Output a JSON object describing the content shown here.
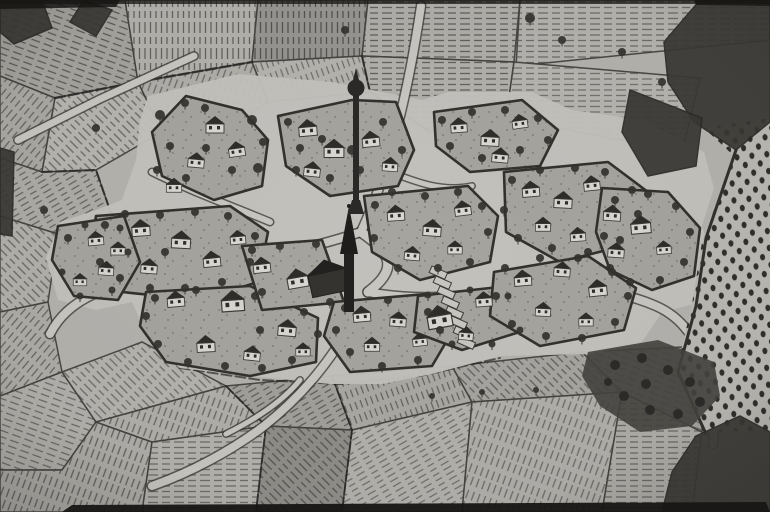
{
  "map": {
    "kind": "scanned-woodcut-village-map",
    "width": 770,
    "height": 512
  },
  "palette": {
    "paper": "#b4b2ad",
    "ground": "#c3c1bc",
    "island": "#a6a49e",
    "ink": "#3b3936",
    "inkDark": "#22211f",
    "hatch": "#504e4a",
    "wall": "#d9d7d1",
    "roof": "#2e2d2a",
    "tree": "#33322e",
    "forest": "#3a3834",
    "grove": "#45433e",
    "orchardBase": "#bab8b3",
    "orchardDot": "#2f2e2b",
    "road": "#c8c6c1",
    "black": "#161513"
  },
  "patterns": [
    {
      "id": "h0",
      "angle": 0,
      "sp": 5.5,
      "w": 1.3,
      "dash": "7 4"
    },
    {
      "id": "h20",
      "angle": 20,
      "sp": 6,
      "w": 1.3,
      "dash": "9 5"
    },
    {
      "id": "h40",
      "angle": 40,
      "sp": 6,
      "w": 1.2,
      "dash": "8 4"
    },
    {
      "id": "h60",
      "angle": 60,
      "sp": 5.5,
      "w": 1.2,
      "dash": "7 5"
    },
    {
      "id": "h90",
      "angle": 90,
      "sp": 5.5,
      "w": 1.3,
      "dash": "8 4"
    },
    {
      "id": "h110",
      "angle": 110,
      "sp": 6,
      "w": 1.2,
      "dash": "9 4"
    },
    {
      "id": "h135",
      "angle": 135,
      "sp": 6,
      "w": 1.3,
      "dash": "7 4"
    },
    {
      "id": "h160",
      "angle": 160,
      "sp": 5.5,
      "w": 1.2,
      "dash": "8 5"
    }
  ],
  "fields": [
    {
      "pts": "0,0 125,0 138,82 55,98 0,76",
      "tint": "#a5a39e",
      "pat": "h110",
      "o": 0.9
    },
    {
      "pts": "125,0 258,0 252,62 138,82",
      "tint": "#b3b1ac",
      "pat": "h0",
      "o": 0.8
    },
    {
      "pts": "258,0 368,0 362,56 252,62",
      "tint": "#969490",
      "pat": "h0",
      "o": 0.95
    },
    {
      "pts": "368,0 520,0 514,62 362,56",
      "tint": "#b0aea9",
      "pat": "h90",
      "o": 0.8
    },
    {
      "pts": "520,0 770,0 770,40 516,66",
      "tint": "#b5b3ae",
      "pat": "h90",
      "o": 0.7
    },
    {
      "pts": "0,76 55,98 42,172 0,158",
      "tint": "#aaa8a3",
      "pat": "h40",
      "o": 0.8
    },
    {
      "pts": "55,98 138,82 162,132 96,170 42,172",
      "tint": "#b8b6b1",
      "pat": "h135",
      "o": 0.75
    },
    {
      "pts": "138,82 252,62 268,102 206,142 162,132",
      "tint": "#b0aea9",
      "pat": "h20",
      "o": 0.7
    },
    {
      "pts": "252,62 362,56 370,92 268,102",
      "tint": "#b6b4af",
      "pat": "h160",
      "o": 0.7
    },
    {
      "pts": "362,56 514,62 506,118 430,132 370,92",
      "tint": "#b2b0ab",
      "pat": "h90",
      "o": 0.8
    },
    {
      "pts": "514,62 700,78 682,152 506,118",
      "tint": "#b7b5b0",
      "pat": "h90",
      "o": 0.65
    },
    {
      "pts": "0,158 42,172 96,170 112,216 58,234 0,216",
      "tint": "#adaba6",
      "pat": "h60",
      "o": 0.8
    },
    {
      "pts": "0,216 58,234 48,302 0,312",
      "tint": "#b2b0ab",
      "pat": "h135",
      "o": 0.75
    },
    {
      "pts": "0,312 48,302 62,372 0,396",
      "tint": "#aeaca7",
      "pat": "h40",
      "o": 0.8
    },
    {
      "pts": "0,396 62,372 96,422 62,470 0,470",
      "tint": "#b3b1ac",
      "pat": "h110",
      "o": 0.75
    },
    {
      "pts": "0,470 62,470 96,422 152,442 142,512 0,512",
      "tint": "#afada8",
      "pat": "h20",
      "o": 0.8
    },
    {
      "pts": "62,372 142,342 226,386 96,422",
      "tint": "#b6b4af",
      "pat": "h135",
      "o": 0.7
    },
    {
      "pts": "96,422 226,386 266,426 152,442",
      "tint": "#b1afaa",
      "pat": "h20",
      "o": 0.75
    },
    {
      "pts": "152,442 266,426 256,512 142,512",
      "tint": "#b4b2ad",
      "pat": "h90",
      "o": 0.7
    },
    {
      "pts": "226,386 332,376 352,430 266,426",
      "tint": "#a2a09b",
      "pat": "h60",
      "o": 0.85
    },
    {
      "pts": "266,426 352,430 342,512 256,512",
      "tint": "#8f8d88",
      "pat": "h135",
      "o": 0.9
    },
    {
      "pts": "332,376 452,366 472,402 352,430",
      "tint": "#aaa8a3",
      "pat": "h160",
      "o": 0.8
    },
    {
      "pts": "352,430 472,402 462,512 342,512",
      "tint": "#b3b1ac",
      "pat": "h60",
      "o": 0.7
    },
    {
      "pts": "452,366 582,352 622,392 472,402",
      "tint": "#a7a5a0",
      "pat": "h135",
      "o": 0.8
    },
    {
      "pts": "472,402 622,392 602,512 462,512",
      "tint": "#b1afaa",
      "pat": "h20",
      "o": 0.7
    },
    {
      "pts": "602,512 622,392 702,432 692,512",
      "tint": "#aeaca7",
      "pat": "h90",
      "o": 0.7
    },
    {
      "pts": "582,352 702,346 702,432 622,392",
      "tint": "#a5a39e",
      "pat": "h110",
      "o": 0.7
    }
  ],
  "seams": [
    {
      "pts": "42,172 96,170 112,216",
      "w": 2.2
    },
    {
      "pts": "362,56 370,92 430,132",
      "w": 2.2
    },
    {
      "pts": "226,386 266,426 256,512",
      "w": 2
    },
    {
      "pts": "332,376 352,430 342,512",
      "w": 2
    },
    {
      "pts": "55,98 138,82 252,62",
      "w": 2.5
    },
    {
      "pts": "180,368 260,380 340,384 420,376 500,358",
      "w": 2
    }
  ],
  "villageGround": {
    "pts": "148,96 238,74 332,82 422,100 448,92 532,92 572,110 642,120 704,152 714,188 702,226 714,264 702,302 662,312 642,342 592,354 500,356 432,374 382,384 330,384 230,374 180,368 150,342 132,302 96,310 58,300 46,258 60,222 96,210 122,200 136,160 140,120"
  },
  "islands": [
    {
      "pts": "186,96 242,110 268,140 262,186 214,200 162,176 152,132"
    },
    {
      "pts": "278,116 352,100 396,102 414,150 398,186 330,196 286,166"
    },
    {
      "pts": "434,112 522,100 558,130 540,166 470,172 436,146"
    },
    {
      "pts": "96,216 230,206 268,232 258,282 200,300 122,292 90,256"
    },
    {
      "pts": "58,226 124,216 140,262 118,300 74,296 52,260"
    },
    {
      "pts": "146,292 250,286 318,318 316,362 250,376 166,362 140,326"
    },
    {
      "pts": "242,246 322,240 344,302 262,310"
    },
    {
      "pts": "334,302 426,294 452,332 432,366 350,372 324,336"
    },
    {
      "pts": "418,296 508,286 526,330 462,350 414,332"
    },
    {
      "pts": "364,196 468,186 498,216 490,262 420,280 372,252"
    },
    {
      "pts": "504,172 608,162 648,192 638,242 560,262 506,232"
    },
    {
      "pts": "494,272 588,256 636,288 624,330 540,346 490,316"
    },
    {
      "pts": "602,188 668,192 700,228 694,276 652,290 610,270 596,232"
    }
  ],
  "roads": [
    {
      "d": "M18,140 L100,99 L194,56",
      "w": 7
    },
    {
      "d": "M421,6 C413,60 401,120 385,170 C377,196 369,214 361,232",
      "w": 8
    },
    {
      "d": "M361,232 C300,252 258,258 200,262 C160,266 122,277 94,294 C72,304 58,318 50,334",
      "w": 8
    },
    {
      "d": "M368,292 C420,302 468,296 520,289 C570,283 622,291 656,306 C686,319 700,346 707,374 C713,399 715,420 713,444",
      "w": 8
    },
    {
      "d": "M354,318 C332,360 302,396 264,426 C232,450 192,472 152,486",
      "w": 8
    },
    {
      "d": "M300,380 C282,402 254,420 226,434",
      "w": 5
    },
    {
      "d": "M152,172 C192,192 232,206 270,222",
      "w": 6
    },
    {
      "d": "M385,170 C420,184 444,192 472,186",
      "w": 5
    },
    {
      "d": "M361,232 C390,252 400,268 368,292",
      "w": 9
    }
  ],
  "gardenPlots": {
    "x0": 432,
    "y0": 266,
    "dx": 4,
    "dy": 10,
    "n": 8,
    "w": 17,
    "h": 7,
    "rot": 24
  },
  "houses": [
    [
      215,
      128,
      1,
      0
    ],
    [
      237,
      152,
      0.9,
      -8
    ],
    [
      196,
      163,
      0.9,
      5
    ],
    [
      174,
      188,
      0.85,
      0
    ],
    [
      308,
      131,
      1,
      -5
    ],
    [
      334,
      152,
      1.1,
      0
    ],
    [
      312,
      172,
      0.9,
      6
    ],
    [
      371,
      142,
      0.95,
      -6
    ],
    [
      390,
      167,
      0.85,
      4
    ],
    [
      459,
      128,
      0.9,
      -4
    ],
    [
      490,
      141,
      1,
      3
    ],
    [
      520,
      124,
      0.85,
      -8
    ],
    [
      500,
      158,
      0.9,
      5
    ],
    [
      141,
      231,
      1,
      -4
    ],
    [
      181,
      243,
      1.05,
      3
    ],
    [
      212,
      262,
      0.95,
      -6
    ],
    [
      149,
      269,
      0.9,
      4
    ],
    [
      118,
      251,
      0.8,
      0
    ],
    [
      238,
      240,
      0.85,
      -5
    ],
    [
      96,
      241,
      0.85,
      -5
    ],
    [
      106,
      271,
      0.85,
      4
    ],
    [
      80,
      282,
      0.75,
      0
    ],
    [
      176,
      302,
      0.95,
      -5
    ],
    [
      233,
      305,
      1.25,
      -4
    ],
    [
      287,
      331,
      1,
      5
    ],
    [
      206,
      347,
      1,
      -3
    ],
    [
      252,
      356,
      0.9,
      6
    ],
    [
      303,
      352,
      0.8,
      0
    ],
    [
      262,
      268,
      0.95,
      -6
    ],
    [
      298,
      282,
      1.15,
      -10
    ],
    [
      362,
      317,
      0.95,
      -5
    ],
    [
      398,
      322,
      0.9,
      4
    ],
    [
      372,
      347,
      0.85,
      0
    ],
    [
      420,
      342,
      0.8,
      -6
    ],
    [
      440,
      321,
      1.35,
      -10
    ],
    [
      484,
      302,
      0.9,
      -4
    ],
    [
      466,
      336,
      0.8,
      5
    ],
    [
      396,
      216,
      0.95,
      -4
    ],
    [
      432,
      231,
      1,
      4
    ],
    [
      463,
      211,
      0.9,
      -7
    ],
    [
      412,
      256,
      0.85,
      5
    ],
    [
      455,
      250,
      0.8,
      0
    ],
    [
      531,
      192,
      0.95,
      -5
    ],
    [
      563,
      203,
      1,
      3
    ],
    [
      592,
      186,
      0.9,
      -6
    ],
    [
      612,
      216,
      0.95,
      4
    ],
    [
      543,
      227,
      0.85,
      0
    ],
    [
      578,
      237,
      0.85,
      -4
    ],
    [
      523,
      281,
      0.95,
      -5
    ],
    [
      562,
      272,
      0.9,
      4
    ],
    [
      598,
      291,
      1,
      -6
    ],
    [
      543,
      312,
      0.85,
      3
    ],
    [
      586,
      322,
      0.8,
      0
    ],
    [
      641,
      228,
      1.1,
      -5
    ],
    [
      616,
      253,
      0.9,
      4
    ],
    [
      664,
      250,
      0.8,
      -4
    ]
  ],
  "trees": [
    [
      160,
      115,
      5
    ],
    [
      185,
      103,
      4
    ],
    [
      205,
      108,
      4
    ],
    [
      252,
      120,
      5
    ],
    [
      263,
      142,
      4
    ],
    [
      258,
      168,
      5
    ],
    [
      206,
      148,
      4
    ],
    [
      170,
      146,
      4
    ],
    [
      157,
      170,
      4
    ],
    [
      232,
      170,
      4
    ],
    [
      186,
      178,
      4
    ],
    [
      288,
      122,
      4
    ],
    [
      300,
      148,
      4
    ],
    [
      322,
      139,
      4
    ],
    [
      352,
      150,
      5
    ],
    [
      360,
      170,
      4
    ],
    [
      330,
      178,
      4
    ],
    [
      296,
      170,
      4
    ],
    [
      383,
      122,
      4
    ],
    [
      402,
      150,
      4
    ],
    [
      442,
      120,
      4
    ],
    [
      472,
      112,
      4
    ],
    [
      505,
      110,
      4
    ],
    [
      538,
      118,
      4
    ],
    [
      548,
      140,
      4
    ],
    [
      520,
      150,
      4
    ],
    [
      482,
      158,
      4
    ],
    [
      450,
      146,
      4
    ],
    [
      105,
      225,
      4
    ],
    [
      125,
      214,
      4
    ],
    [
      160,
      215,
      4
    ],
    [
      195,
      212,
      4
    ],
    [
      228,
      216,
      4
    ],
    [
      255,
      236,
      4
    ],
    [
      250,
      262,
      4
    ],
    [
      222,
      282,
      4
    ],
    [
      185,
      288,
      4
    ],
    [
      150,
      288,
      4
    ],
    [
      120,
      278,
      4
    ],
    [
      100,
      262,
      4
    ],
    [
      165,
      252,
      4
    ],
    [
      68,
      238,
      4
    ],
    [
      85,
      225,
      3.5
    ],
    [
      120,
      228,
      3.5
    ],
    [
      128,
      252,
      3.5
    ],
    [
      112,
      290,
      3.5
    ],
    [
      80,
      296,
      3.5
    ],
    [
      62,
      272,
      3.5
    ],
    [
      155,
      298,
      4
    ],
    [
      196,
      290,
      4
    ],
    [
      262,
      292,
      4
    ],
    [
      304,
      312,
      4
    ],
    [
      318,
      334,
      4
    ],
    [
      292,
      360,
      4
    ],
    [
      262,
      368,
      4
    ],
    [
      225,
      366,
      4
    ],
    [
      188,
      362,
      4
    ],
    [
      158,
      344,
      4
    ],
    [
      146,
      316,
      4
    ],
    [
      260,
      330,
      4
    ],
    [
      252,
      250,
      4
    ],
    [
      280,
      246,
      4
    ],
    [
      316,
      244,
      4
    ],
    [
      255,
      296,
      4
    ],
    [
      330,
      302,
      4
    ],
    [
      345,
      308,
      4
    ],
    [
      388,
      300,
      4
    ],
    [
      428,
      312,
      4
    ],
    [
      440,
      330,
      4
    ],
    [
      418,
      360,
      4
    ],
    [
      382,
      366,
      4
    ],
    [
      350,
      352,
      4
    ],
    [
      336,
      330,
      4
    ],
    [
      428,
      295,
      3.5
    ],
    [
      470,
      290,
      3.5
    ],
    [
      508,
      296,
      3.5
    ],
    [
      520,
      330,
      3.5
    ],
    [
      492,
      344,
      3.5
    ],
    [
      452,
      344,
      3.5
    ],
    [
      375,
      205,
      4
    ],
    [
      392,
      192,
      4
    ],
    [
      425,
      196,
      4
    ],
    [
      458,
      192,
      4
    ],
    [
      482,
      206,
      4
    ],
    [
      488,
      232,
      4
    ],
    [
      470,
      262,
      4
    ],
    [
      438,
      268,
      4
    ],
    [
      398,
      268,
      4
    ],
    [
      374,
      238,
      4
    ],
    [
      512,
      180,
      4
    ],
    [
      540,
      170,
      4
    ],
    [
      575,
      168,
      4
    ],
    [
      605,
      172,
      4
    ],
    [
      632,
      190,
      4
    ],
    [
      638,
      214,
      4
    ],
    [
      620,
      240,
      4
    ],
    [
      588,
      252,
      4
    ],
    [
      552,
      248,
      4
    ],
    [
      518,
      238,
      4
    ],
    [
      504,
      210,
      4
    ],
    [
      505,
      268,
      4
    ],
    [
      540,
      258,
      4
    ],
    [
      578,
      258,
      4
    ],
    [
      612,
      272,
      4
    ],
    [
      628,
      296,
      4
    ],
    [
      615,
      322,
      4
    ],
    [
      582,
      338,
      4
    ],
    [
      546,
      336,
      4
    ],
    [
      512,
      324,
      4
    ],
    [
      496,
      296,
      4
    ],
    [
      615,
      200,
      4
    ],
    [
      648,
      194,
      4
    ],
    [
      676,
      206,
      4
    ],
    [
      690,
      232,
      4
    ],
    [
      684,
      262,
      4
    ],
    [
      660,
      280,
      4
    ],
    [
      630,
      282,
      4
    ],
    [
      610,
      268,
      4
    ],
    [
      604,
      236,
      4
    ],
    [
      345,
      30,
      4
    ],
    [
      530,
      18,
      5
    ],
    [
      562,
      40,
      4
    ],
    [
      622,
      52,
      4
    ],
    [
      662,
      82,
      4
    ],
    [
      96,
      128,
      4
    ],
    [
      44,
      210,
      4
    ],
    [
      536,
      390,
      3
    ],
    [
      482,
      392,
      3
    ],
    [
      432,
      396,
      3
    ]
  ],
  "church": {
    "cx": 349,
    "spireTipY": 206,
    "spireBaseY": 254,
    "towerW": 10,
    "towerTopY": 248,
    "towerBottomY": 312,
    "nave": {
      "x": 310,
      "y": 272,
      "w": 38,
      "h": 22,
      "rot": -12
    }
  },
  "minaret": {
    "cx": 356,
    "bodyTopY": 96,
    "bodyW": 6,
    "baseY": 214,
    "bulbY": 88,
    "bulbR": 8.5
  },
  "orchard": {
    "pts": "704,128 770,118 770,430 704,432 676,372 692,304 702,242 734,156",
    "edge": "736,150 706,238 696,306 678,372 706,434"
  },
  "grove": {
    "pts": "588,352 658,340 714,362 720,396 692,426 640,432 600,406 582,376",
    "trees": [
      [
        615,
        365,
        5
      ],
      [
        642,
        358,
        5
      ],
      [
        668,
        370,
        5
      ],
      [
        690,
        382,
        5
      ],
      [
        700,
        402,
        5
      ],
      [
        678,
        414,
        5
      ],
      [
        650,
        410,
        5
      ],
      [
        624,
        396,
        5
      ],
      [
        646,
        384,
        5
      ],
      [
        608,
        382,
        4
      ]
    ]
  },
  "forests": [
    {
      "pts": "664,42 700,0 770,0 770,122 736,150 694,122 668,82"
    },
    {
      "pts": "630,90 702,118 696,166 648,176 622,132"
    },
    {
      "pts": "696,436 740,416 770,432 770,512 662,512 672,472"
    },
    {
      "pts": "0,0 42,0 52,28 14,44 0,32"
    },
    {
      "pts": "84,0 112,10 96,36 70,22"
    },
    {
      "pts": "0,148 14,152 12,236 0,234"
    }
  ],
  "strips": [
    {
      "pts": "0,0 770,0 770,4 0,4",
      "o": 0.75
    },
    {
      "pts": "0,0 120,0 116,7 0,9",
      "o": 0.85
    },
    {
      "pts": "694,0 770,0 770,6 696,5",
      "o": 0.8
    },
    {
      "pts": "62,512 72,505 766,502 770,512",
      "o": 0.95
    }
  ]
}
